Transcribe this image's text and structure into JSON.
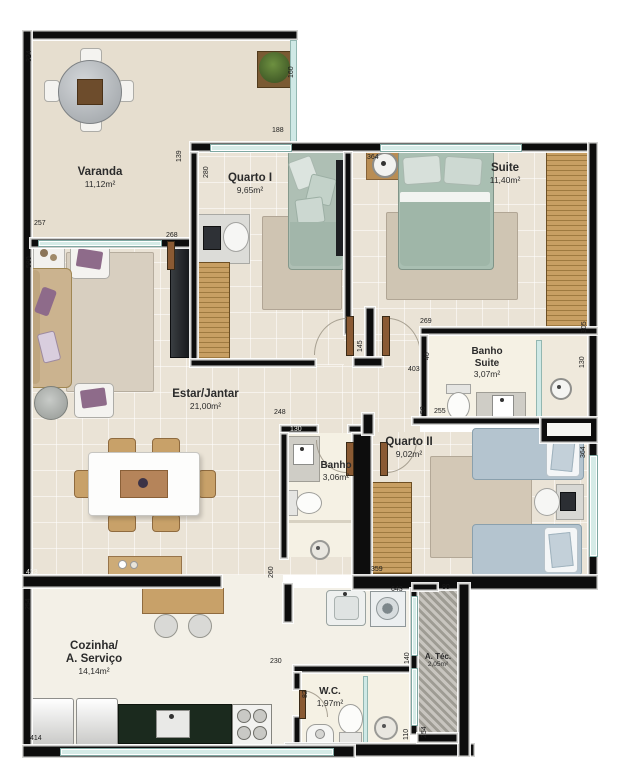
{
  "title": "Planta do apartamento",
  "rooms": {
    "varanda": {
      "name": "Varanda",
      "area": "11,12m²"
    },
    "quarto1": {
      "name": "Quarto I",
      "area": "9,65m²"
    },
    "suite": {
      "name": "Suite",
      "area": "11,40m²"
    },
    "banho_suite": {
      "name_line1": "Banho",
      "name_line2": "Suite",
      "area": "3,07m²"
    },
    "estar": {
      "name": "Estar/Jantar",
      "area": "21,00m²"
    },
    "banho": {
      "name": "Banho",
      "area": "3,06m²"
    },
    "quarto2": {
      "name": "Quarto II",
      "area": "9,02m²"
    },
    "cozinha": {
      "name_line1": "Cozinha/",
      "name_line2": "A. Serviço",
      "area": "14,14m²"
    },
    "atec": {
      "name": "A. Téc.",
      "area": "2,05m²"
    },
    "wc": {
      "name": "W.C.",
      "area": "1,97m²"
    }
  },
  "dims": {
    "varanda_left": "324",
    "varanda_estar_window": "257",
    "estar_left": "580",
    "varanda_rail": "160",
    "quarto1_window": "188",
    "q1_varanda_wall": "139",
    "quarto1_left": "280",
    "varanda_door": "268",
    "suite_window": "364",
    "hall_door": "145",
    "banho_suite_top": "269",
    "bs_nook": "40",
    "bs_left": "403",
    "bs_bottom_left": "50",
    "bs_width": "255",
    "suite_wardrobe": "305",
    "bs_shower": "130",
    "quarto2_window": "364",
    "banho_top": "248",
    "banho_inner": "130",
    "banho_left": "260",
    "quarto2_wardrobe": "359",
    "estar_bottom": "423",
    "estar_left_low": "254",
    "cozinha_bottom": "414",
    "laundry": "643",
    "atec_top": "80",
    "wc_top": "230",
    "wc_door": "82",
    "atec_upper": "140",
    "atec_lower": "110",
    "atec_right": "254"
  },
  "colors": {
    "wall": "#0d0d0d",
    "window_glass": "#d5ebe7",
    "wood": "#c89f63",
    "bed_green": "#a9bfb2",
    "bed_blue": "#b4c4cf",
    "accent_purple": "#8e6b8a",
    "counter_dark": "#1b2a1e"
  }
}
